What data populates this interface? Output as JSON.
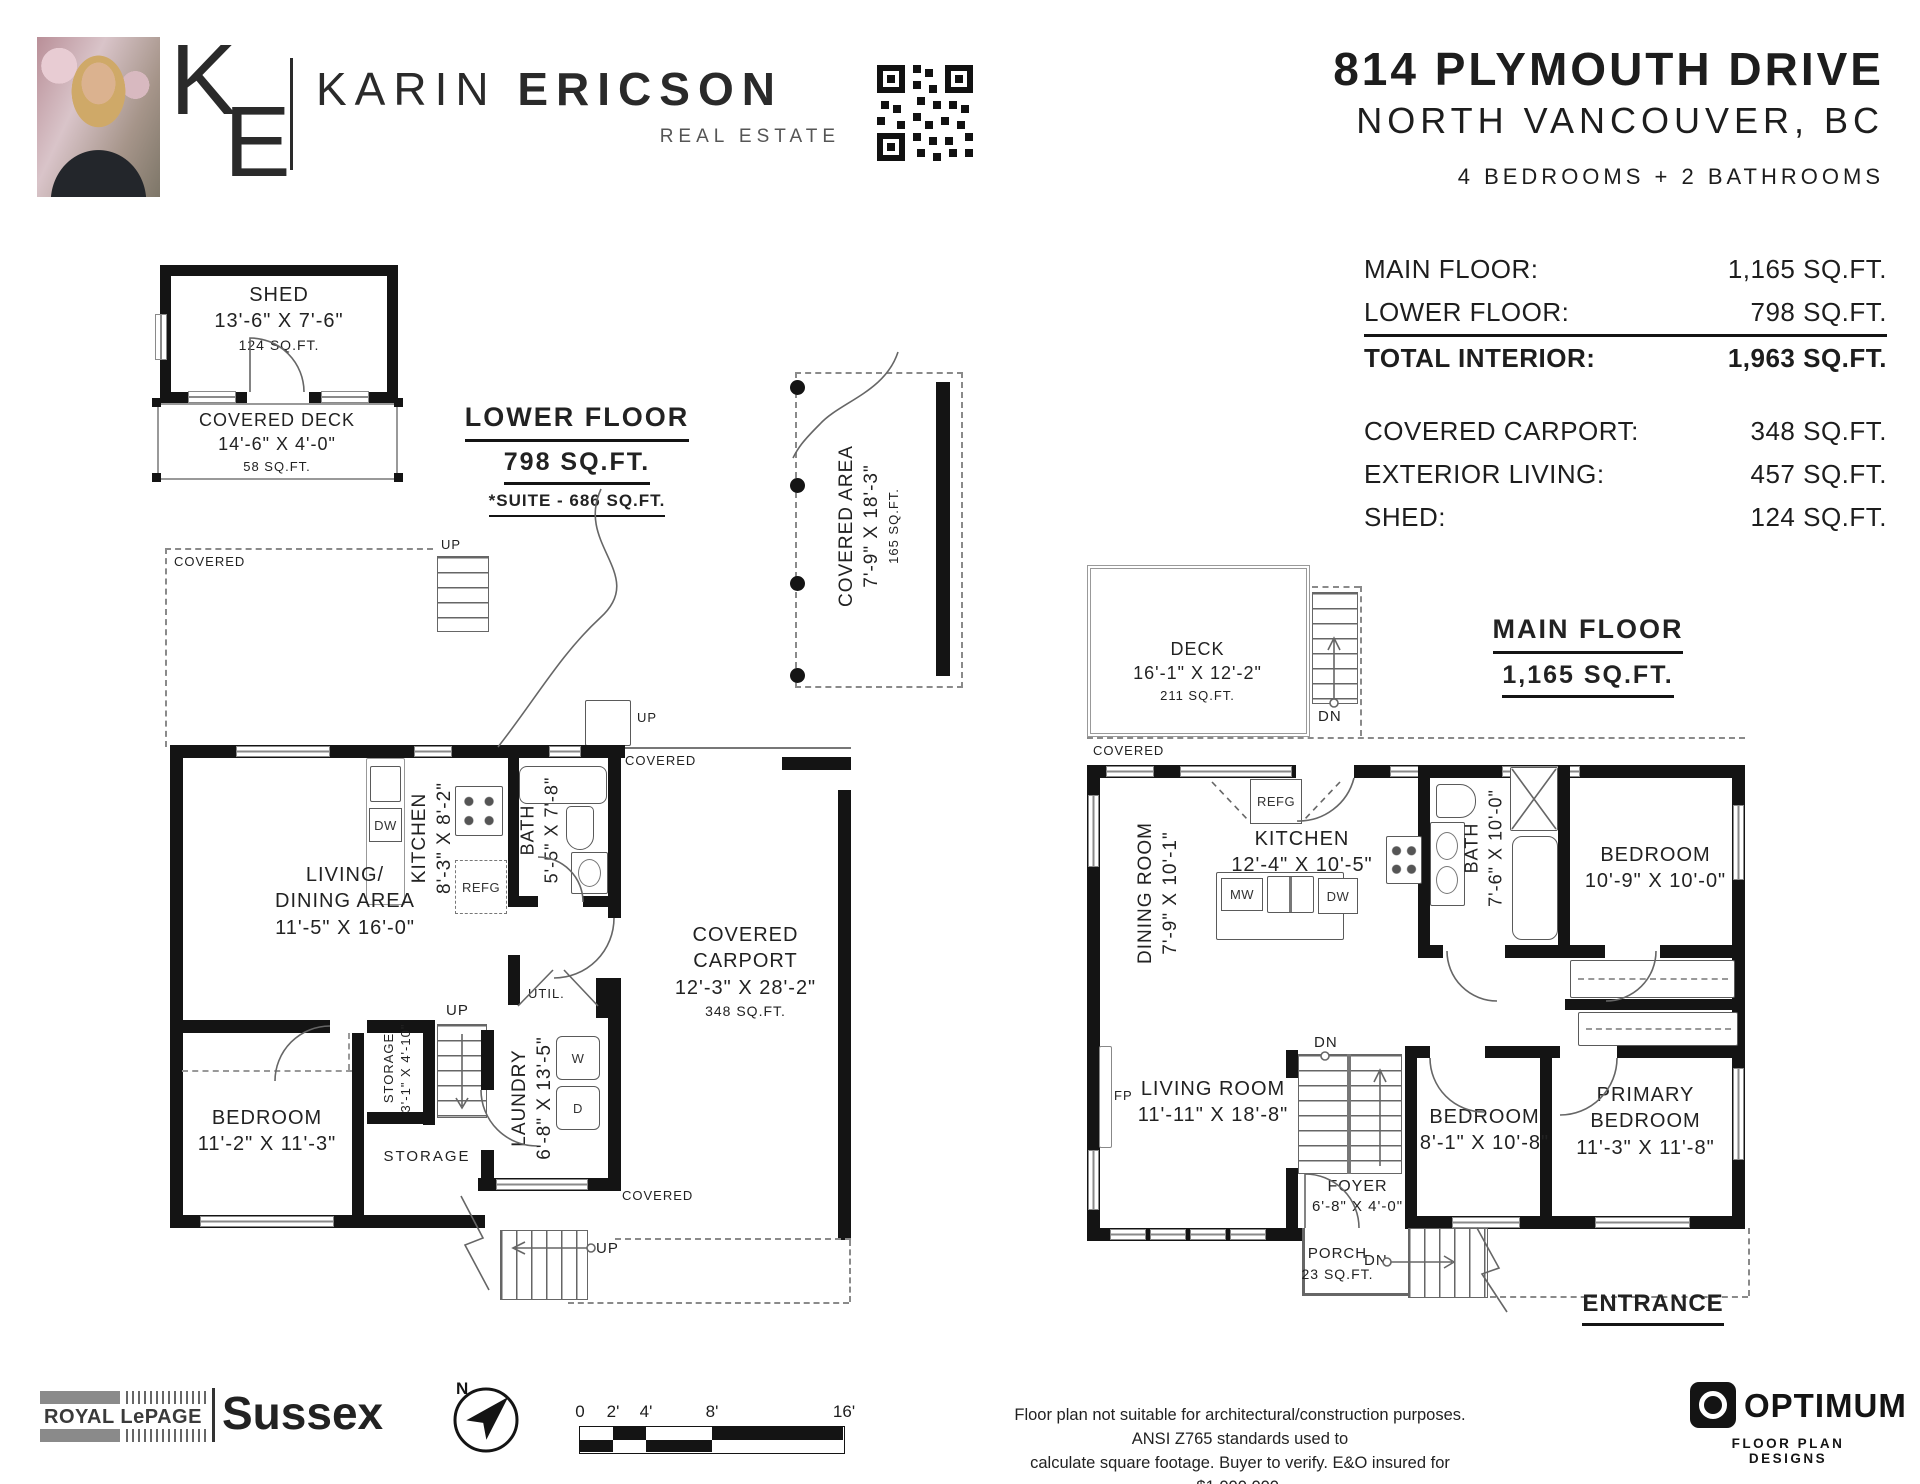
{
  "header": {
    "logo_k": "K",
    "logo_e": "E",
    "agent_first": "KARIN",
    "agent_last": "ERICSON",
    "agent_subtitle": "REAL ESTATE",
    "address1": "814 PLYMOUTH DRIVE",
    "address2": "NORTH VANCOUVER, BC",
    "beds_baths": "4 BEDROOMS + 2 BATHROOMS"
  },
  "stats": {
    "group1": [
      {
        "label": "MAIN FLOOR:",
        "value": "1,165 SQ.FT."
      },
      {
        "label": "LOWER FLOOR:",
        "value": "798 SQ.FT."
      },
      {
        "label": "TOTAL INTERIOR:",
        "value": "1,963 SQ.FT."
      }
    ],
    "group2": [
      {
        "label": "COVERED CARPORT:",
        "value": "348 SQ.FT."
      },
      {
        "label": "EXTERIOR LIVING:",
        "value": "457 SQ.FT."
      },
      {
        "label": "SHED:",
        "value": "124 SQ.FT."
      }
    ]
  },
  "labels": {
    "covered": "COVERED",
    "up": "UP",
    "dn": "DN",
    "storage": "STORAGE",
    "util": "UTIL.",
    "refg": "REFG",
    "dw": "DW",
    "mw": "MW",
    "w": "W",
    "d": "D",
    "fp": "FP",
    "north": "N",
    "entrance": "ENTRANCE"
  },
  "lower": {
    "title": "LOWER FLOOR",
    "area": "798 SQ.FT.",
    "suite": "*SUITE - 686 SQ.FT.",
    "shed": {
      "name": "SHED",
      "dims": "13'-6\" X 7'-6\"",
      "area": "124 SQ.FT."
    },
    "covered_deck": {
      "name": "COVERED DECK",
      "dims": "14'-6\" X 4'-0\"",
      "area": "58 SQ.FT."
    },
    "covered_area": {
      "name": "COVERED AREA",
      "dims": "7'-9\" X 18'-3\"",
      "area": "165 SQ.FT."
    },
    "living": {
      "name": "LIVING/\nDINING AREA",
      "dims": "11'-5\" X 16'-0\""
    },
    "kitchen": {
      "name": "KITCHEN",
      "dims": "8'-3\" X 8'-2\""
    },
    "bath": {
      "name": "BATH",
      "dims": "5'-5\" X 7'-8\""
    },
    "bedroom": {
      "name": "BEDROOM",
      "dims": "11'-2\" X 11'-3\""
    },
    "storage_closet": {
      "name": "STORAGE",
      "dims": "3'-1\" X 4'-10\""
    },
    "laundry": {
      "name": "LAUNDRY",
      "dims": "6'-8\" X 13'-5\""
    },
    "carport": {
      "name": "COVERED\nCARPORT",
      "dims": "12'-3\" X 28'-2\"",
      "area": "348 SQ.FT."
    }
  },
  "main": {
    "title": "MAIN FLOOR",
    "area": "1,165 SQ.FT.",
    "deck": {
      "name": "DECK",
      "dims": "16'-1\" X 12'-2\"",
      "area": "211 SQ.FT."
    },
    "dining": {
      "name": "DINING ROOM",
      "dims": "7'-9\" X 10'-1\""
    },
    "kitchen": {
      "name": "KITCHEN",
      "dims": "12'-4\" X 10'-5\""
    },
    "bath": {
      "name": "BATH",
      "dims": "7'-6\" X 10'-0\""
    },
    "bedroom1": {
      "name": "BEDROOM",
      "dims": "10'-9\" X 10'-0\""
    },
    "living": {
      "name": "LIVING ROOM",
      "dims": "11'-11\" X 18'-8\""
    },
    "bedroom2": {
      "name": "BEDROOM",
      "dims": "8'-1\" X 10'-8\""
    },
    "primary": {
      "name": "PRIMARY\nBEDROOM",
      "dims": "11'-3\" X 11'-8\""
    },
    "foyer": {
      "name": "FOYER",
      "dims": "6'-8\" X 4'-0\""
    },
    "porch": {
      "name": "PORCH",
      "area": "23 SQ.FT."
    }
  },
  "footer": {
    "brand_primary": "ROYAL LePAGE",
    "brand_secondary": "Sussex",
    "scale_ticks": [
      "0",
      "2'",
      "4'",
      "8'",
      "16'"
    ],
    "disclaimer1": "Floor plan not suitable for architectural/construction purposes. ANSI Z765 standards used to",
    "disclaimer2": "calculate square footage. Buyer to verify. E&O insured for $1,000,000.",
    "designer_name": "OPTIMUM",
    "designer_sub": "FLOOR PLAN DESIGNS"
  }
}
